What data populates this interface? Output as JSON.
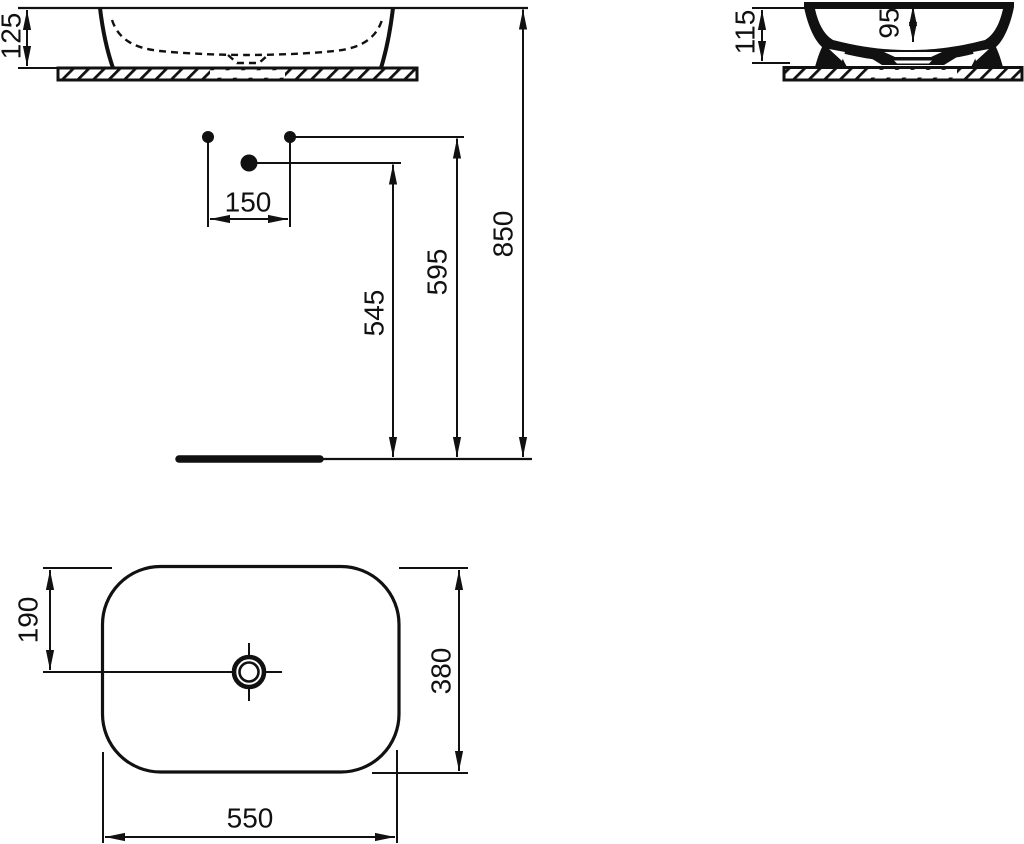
{
  "colors": {
    "ink": "#111111",
    "background": "#ffffff"
  },
  "front_view": {
    "basin_height": "125"
  },
  "side_view": {
    "overall_height": "115",
    "bowl_depth": "95"
  },
  "installation": {
    "hole_spacing": "150",
    "mid_height": "545",
    "upper_height": "595",
    "rim_height": "850"
  },
  "plan_view": {
    "drain_offset": "190",
    "depth": "380",
    "width": "550"
  }
}
